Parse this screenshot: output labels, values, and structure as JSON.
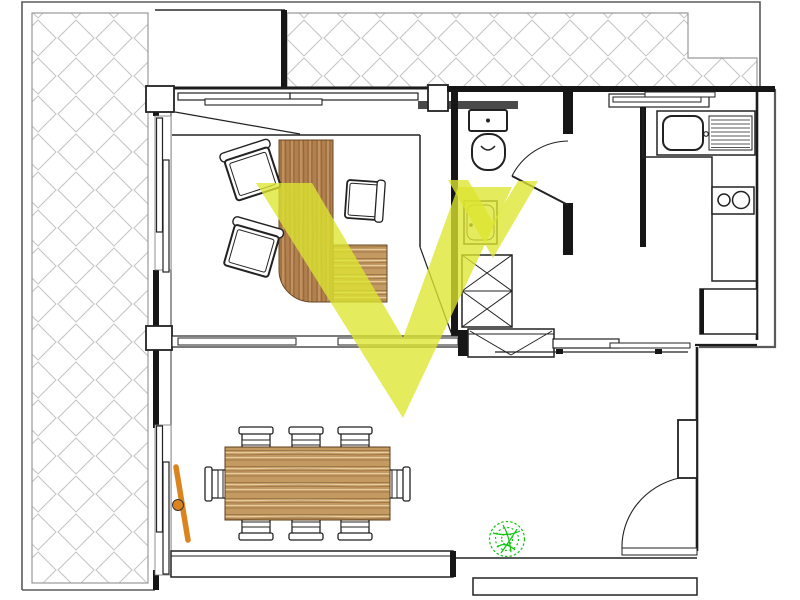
{
  "plan": {
    "type": "apartment-floor-plan",
    "rooms": [
      "left-terrace",
      "top-terrace",
      "home-office",
      "bathroom",
      "hallway",
      "kitchen",
      "living-dining-room"
    ],
    "fixtures": [
      "office-desk",
      "office-chair",
      "office-chair",
      "guest-chair",
      "toilet",
      "washbasin",
      "wardrobe",
      "shoe-cabinet",
      "kitchen-sink-with-drainer",
      "two-burner-stove",
      "fridge",
      "dining-table",
      "dining-chairs-8",
      "potted-plant",
      "entry-door",
      "bathroom-door",
      "open-window-leaf",
      "sliding-windows"
    ],
    "highlights": [
      "large-view-cone-v",
      "small-view-cone-v"
    ]
  },
  "colors": {
    "wall": "#161616",
    "outer_boundary": "#5a5a5a",
    "hatch_line": "#c6c6c6",
    "hatch_border": "#9a9a9a",
    "wood_desk": "#b2804e",
    "wood_desk_grain": "#7e5428",
    "wood_table": "#c49a63",
    "wood_table_grain": "#8a5f30",
    "wood_table_light": "#ecd8ae",
    "highlight_yellow": "rgba(221,229,48,0.78)",
    "plant_green": "#10c410",
    "door_orange": "#da831f",
    "dark_bar": "#4a4a4a"
  }
}
